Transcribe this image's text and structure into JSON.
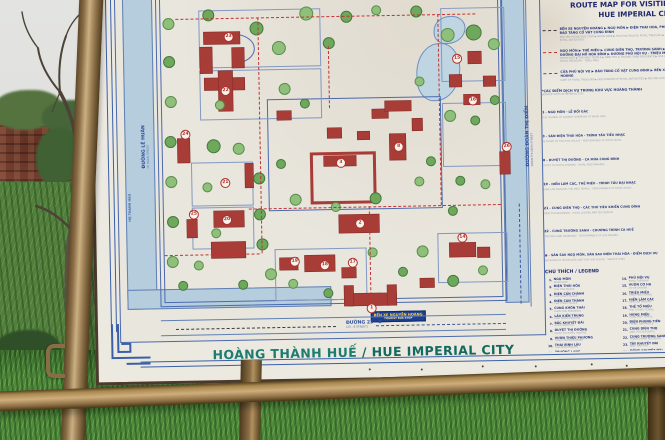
{
  "signboard": {
    "title": {
      "vi": "HOÀNG THÀNH HUẾ",
      "sep": " / ",
      "en": "HUE IMPERIAL CITY"
    },
    "bus_stop": {
      "line1": "BẾN XE NGUYỄN HOÀNG",
      "line2": "TOURIST BUS STOP"
    }
  },
  "legend": {
    "corner_code": "HMCC",
    "title_line1": "ROUTE MAP FOR VISITING",
    "title_line2": "HUE IMPERIAL CITY",
    "routes": [
      {
        "style": "black",
        "vi": "BẾN XE NGUYỄN HOÀNG ▶ NGỌ MÔN ▶ ĐIỆN THÁI HÒA, PHỦ NỘI VỤ ▶ BẢO TÀNG CỔ VẬT CUNG ĐÌNH",
        "en": "NGUYEN HOANG BUS STOP ▶ NOON GATE ▶ THAI HOA PALACE, ROYAL TREASURY ▶ HUE MUSEUM OF ROYAL ANTIQUITIES"
      },
      {
        "style": "red",
        "vi": "NGỌ MÔN ▶ THẾ MIẾU ▶ CUNG DIÊN THỌ, TRƯỜNG SANH ▶ TUYẾN ĐƯỜNG ĐẠI HỒ HÒA BÌNH ▶ ĐƯỜNG PHỦ NỘI VỤ - TRIỆU MIẾU",
        "en": "NOON GATE ▶ THE MIEU TEMPLE ▶ DIEN THO & TRUONG SANH RESIDENCE ▶ HOA BINH GATE ROUTE ▶ ROYAL TREASURY - TRIEU MIEU"
      },
      {
        "style": "blue",
        "vi": "CỬA PHỦ NỘI VỤ ▶ BẢO TÀNG CỔ VẬT CUNG ĐÌNH ▶ BẾN XE NGUYỄN HOÀNG",
        "en": "GATE OF ROYAL TREASURY ▶ HUE MUSEUM OF ROYAL ANTIQUITIES ▶ NGUYEN HOANG BUS STOP"
      }
    ],
    "services": {
      "heading_vi": "*CÁC ĐIỂM DỊCH VỤ TRONG KHU VỰC HOÀNG THÀNH",
      "heading_en": "SERVICE SITES IN IMPERIAL CITY",
      "items": [
        {
          "k": "1",
          "vi": "NGỌ MÔN - LỄ ĐỔI GÁC",
          "en": "THE CHANGE OF GUARDS CEREMONY AT NOON GATE"
        },
        {
          "k": "3",
          "vi": "SÂN ĐIỆN THÁI HÒA - TRÌNH TẤU TIỂU NHẠC",
          "en": "IN FRONT OF THAI HOA PALACE - PERFORMANCE OF ROYAL MUSIC"
        },
        {
          "k": "8",
          "vi": "DUYỆT THỊ ĐƯỜNG - CA MÚA CUNG ĐÌNH",
          "en": "DUYET THI ROYAL THEATRE - ROYAL PERFORMANCE"
        },
        {
          "k": "19",
          "vi": "HIỂN LÂM CÁC, THẾ MIẾU - TRÌNH TẤU ĐẠI NHẠC",
          "en": "HIEN LAM PAVILION, THE MIEU TEMPLE - PERFORMANCE OF ROYAL MUSIC"
        },
        {
          "k": "21",
          "vi": "CUNG DIÊN THỌ - CÁC THÚ TIÊU KHIỂN CUNG ĐÌNH",
          "en": "DIEN THO RESIDENCE - ROYAL LEISURE AND TEA SERVICE"
        },
        {
          "k": "22",
          "vi": "CUNG TRƯỜNG SANH - CHƯƠNG TRÌNH CA HUẾ",
          "en": "TRUONG SANH RESIDENCE - PERFORMANCE OF HUE SINGING"
        },
        {
          "k": "●",
          "vi": "SÂN SAU NGỌ MÔN, SÂN SAU ĐIỆN THÁI HÒA - ĐIỂM DỊCH VỤ",
          "en": "BACKYARD OF NOON GATE AND THAI HOA PALACE - SERVICE SITES"
        }
      ]
    },
    "legend_heading": "CHÚ THÍCH / LEGEND",
    "entries": [
      {
        "n": 1,
        "vi": "NGỌ MÔN",
        "en": "NOON GATE"
      },
      {
        "n": 2,
        "vi": "ĐIỆN THÁI HÒA",
        "en": "THAI HOA PALACE"
      },
      {
        "n": 3,
        "vi": "ĐIỆN CẦN CHÁNH",
        "en": "CAN CHANH PALACE"
      },
      {
        "n": 4,
        "vi": "ĐIỆN CÀN THÀNH",
        "en": "CAN THANH PALACE"
      },
      {
        "n": 5,
        "vi": "CUNG KHÔN THÁI",
        "en": "KHON THAI RESIDENCE"
      },
      {
        "n": 6,
        "vi": "LẦU KIẾN TRUNG",
        "en": "KIEN TRUNG PAVILION"
      },
      {
        "n": 7,
        "vi": "BẮC KHUYẾT ĐÀI",
        "en": "NORTH BASTION"
      },
      {
        "n": 8,
        "vi": "DUYỆT THỊ ĐƯỜNG",
        "en": "DUYET THI ROYAL THEATRE"
      },
      {
        "n": 9,
        "vi": "VƯỜN THIỆU PHƯƠNG",
        "en": "THIEU PHUONG GARDEN"
      },
      {
        "n": 10,
        "vi": "THÁI BÌNH LÂU",
        "en": "THAI BINH PAVILION"
      },
      {
        "n": 11,
        "vi": "TRƯỜNG LANG",
        "en": "LONG CORRIDOR"
      },
      {
        "n": 12,
        "vi": "HỮU TIỀN VIÊN PHÒNG",
        "en": "ROYAL OFFICE"
      },
      {
        "n": 13,
        "vi": "THÁI MIẾU",
        "en": "THAI MIEU TEMPLE"
      },
      {
        "n": 14,
        "vi": "PHỦ NỘI VỤ",
        "en": "ROYAL TREASURY"
      },
      {
        "n": 15,
        "vi": "VƯỜN CƠ HẠ",
        "en": "CO HA GARDEN"
      },
      {
        "n": 16,
        "vi": "TRIỆU MIẾU",
        "en": "TRIEU MIEU TEMPLE"
      },
      {
        "n": 17,
        "vi": "HIỂN LÂM CÁC",
        "en": "HIEN LAM PAVILION"
      },
      {
        "n": 18,
        "vi": "THẾ TỔ MIẾU",
        "en": "THE TO MIEU TEMPLE"
      },
      {
        "n": 19,
        "vi": "HƯNG MIẾU",
        "en": "HUNG MIEU TEMPLE"
      },
      {
        "n": 20,
        "vi": "ĐIỆN PHỤNG TIÊN",
        "en": "PHUNG TIEN PALACE"
      },
      {
        "n": 21,
        "vi": "CUNG DIÊN THỌ",
        "en": "DIEN THO RESIDENCE"
      },
      {
        "n": 22,
        "vi": "CUNG TRƯỜNG SANH",
        "en": "TRUONG SANH RESIDENCE"
      },
      {
        "n": 23,
        "vi": "TÂY KHUYẾT ĐÀI",
        "en": "WEST BASTION"
      },
      {
        "n": 24,
        "vi": "ĐÔNG KHUYẾT ĐÀI",
        "en": "EAST BASTION"
      },
      {
        "n": 25,
        "vi": "CỬA CHƯƠNG ĐỨC",
        "en": "CHUONG DUC GATE"
      },
      {
        "n": 26,
        "vi": "CỬA HIỂN NHƠN",
        "en": "HIEN NHON GATE"
      },
      {
        "n": 27,
        "vi": "CỬA HÒA BÌNH",
        "en": "HOA BINH GATE"
      }
    ]
  },
  "map": {
    "moats": [
      [
        7,
        30,
        28,
        324
      ],
      [
        7,
        336,
        202,
        18
      ],
      [
        385,
        30,
        22,
        324
      ]
    ],
    "lakes": [
      [
        300,
        95,
        42,
        56
      ],
      [
        318,
        68,
        30,
        26
      ]
    ],
    "walls": [
      [
        40,
        22,
        345,
        330
      ],
      [
        44,
        26,
        337,
        322
      ],
      [
        150,
        148,
        172,
        110
      ]
    ],
    "courtyards": [
      [
        73,
        210,
        60,
        42
      ],
      [
        73,
        255,
        60,
        40
      ],
      [
        155,
        298,
        90,
        50
      ],
      [
        318,
        285,
        68,
        48
      ],
      [
        325,
        60,
        62,
        72
      ],
      [
        83,
        58,
        120,
        56
      ],
      [
        83,
        118,
        120,
        48
      ],
      [
        325,
        155,
        62,
        62
      ]
    ],
    "arcs": [
      [
        118,
        82,
        20,
        28
      ]
    ],
    "streets_h": [
      [
        40,
        367,
        345,
        14
      ]
    ],
    "streets_v": [
      [
        410,
        28,
        15,
        332
      ]
    ],
    "buildings": [
      [
        228,
        344,
        48,
        12
      ],
      [
        224,
        336,
        9,
        20
      ],
      [
        267,
        336,
        9,
        20
      ],
      [
        220,
        265,
        40,
        18
      ],
      [
        206,
        206,
        32,
        10
      ],
      [
        160,
        160,
        14,
        9
      ],
      [
        255,
        160,
        16,
        9
      ],
      [
        295,
        170,
        10,
        12
      ],
      [
        210,
        178,
        14,
        10
      ],
      [
        240,
        182,
        12,
        8
      ],
      [
        272,
        185,
        16,
        26
      ],
      [
        268,
        152,
        26,
        10
      ],
      [
        333,
        127,
        12,
        12
      ],
      [
        367,
        129,
        12,
        10
      ],
      [
        347,
        147,
        16,
        10
      ],
      [
        352,
        104,
        13,
        12
      ],
      [
        88,
        80,
        36,
        12
      ],
      [
        84,
        95,
        12,
        26
      ],
      [
        116,
        96,
        12,
        20
      ],
      [
        88,
        126,
        40,
        12
      ],
      [
        102,
        119,
        14,
        40
      ],
      [
        60,
        186,
        12,
        24
      ],
      [
        127,
        212,
        8,
        24
      ],
      [
        95,
        259,
        30,
        16
      ],
      [
        92,
        290,
        34,
        16
      ],
      [
        68,
        267,
        10,
        18
      ],
      [
        185,
        305,
        30,
        16
      ],
      [
        160,
        307,
        18,
        12
      ],
      [
        222,
        318,
        14,
        10
      ],
      [
        330,
        295,
        26,
        14
      ],
      [
        358,
        300,
        12,
        10
      ],
      [
        382,
        205,
        10,
        22
      ],
      [
        300,
        330,
        14,
        9
      ]
    ],
    "red_outlines": [
      [
        192,
        202,
        60,
        46
      ]
    ],
    "markers": [
      [
        1,
        250,
        358
      ],
      [
        2,
        240,
        273
      ],
      [
        3,
        222,
        212
      ],
      [
        8,
        280,
        197
      ],
      [
        14,
        342,
        289
      ],
      [
        15,
        340,
        110
      ],
      [
        16,
        355,
        152
      ],
      [
        17,
        232,
        312
      ],
      [
        18,
        204,
        314
      ],
      [
        19,
        174,
        310
      ],
      [
        20,
        107,
        267
      ],
      [
        21,
        106,
        230
      ],
      [
        22,
        108,
        138
      ],
      [
        23,
        112,
        84
      ],
      [
        24,
        67,
        181
      ],
      [
        25,
        74,
        261
      ],
      [
        26,
        388,
        199
      ]
    ],
    "trees": [
      [
        52,
        70,
        5
      ],
      [
        52,
        108,
        5
      ],
      [
        53,
        148,
        5
      ],
      [
        52,
        188,
        5
      ],
      [
        52,
        228,
        5
      ],
      [
        53,
        268,
        5
      ],
      [
        52,
        308,
        5
      ],
      [
        95,
        193,
        6
      ],
      [
        120,
        196,
        5
      ],
      [
        140,
        226,
        5
      ],
      [
        88,
        234,
        4
      ],
      [
        140,
        262,
        5
      ],
      [
        96,
        280,
        4
      ],
      [
        142,
        292,
        5
      ],
      [
        150,
        322,
        5
      ],
      [
        122,
        332,
        4
      ],
      [
        172,
        332,
        4
      ],
      [
        140,
        76,
        6
      ],
      [
        162,
        96,
        6
      ],
      [
        92,
        62,
        5
      ],
      [
        190,
        62,
        6
      ],
      [
        212,
        92,
        5
      ],
      [
        167,
        137,
        5
      ],
      [
        187,
        152,
        4
      ],
      [
        176,
        248,
        5
      ],
      [
        256,
        248,
        5
      ],
      [
        216,
        256,
        4
      ],
      [
        162,
        212,
        4
      ],
      [
        300,
        232,
        4
      ],
      [
        312,
        212,
        4
      ],
      [
        332,
        167,
        5
      ],
      [
        357,
        172,
        4
      ],
      [
        331,
        86,
        6
      ],
      [
        357,
        84,
        7
      ],
      [
        377,
        96,
        5
      ],
      [
        341,
        232,
        4
      ],
      [
        366,
        236,
        4
      ],
      [
        333,
        262,
        4
      ],
      [
        302,
        302,
        5
      ],
      [
        332,
        332,
        5
      ],
      [
        362,
        322,
        4
      ],
      [
        282,
        322,
        4
      ],
      [
        252,
        302,
        4
      ],
      [
        207,
        342,
        4
      ],
      [
        302,
        132,
        4
      ],
      [
        377,
        152,
        4
      ],
      [
        102,
        152,
        4
      ],
      [
        62,
        332,
        4
      ],
      [
        78,
        312,
        4
      ],
      [
        230,
        66,
        5
      ],
      [
        260,
        60,
        4
      ],
      [
        300,
        62,
        5
      ]
    ],
    "routes_red": [
      [
        "h",
        60,
        66,
        300
      ],
      [
        "v",
        142,
        66,
        236
      ],
      [
        "h",
        45,
        302,
        95
      ],
      [
        "h",
        130,
        257,
        252
      ],
      [
        "v",
        250,
        257,
        104
      ],
      [
        "v",
        322,
        66,
        191
      ],
      [
        "v",
        212,
        96,
        62
      ]
    ],
    "routes_blue": [
      [
        "v",
        400,
        257,
        100
      ],
      [
        "h",
        255,
        376,
        130
      ]
    ],
    "routes_black": [
      [
        "h",
        55,
        376,
        160
      ]
    ],
    "labels": [
      {
        "t": "ĐƯỜNG LÊ HUÂN",
        "s": "LE HUAN STREET",
        "x": 24,
        "y": 215,
        "r": -90,
        "small": false
      },
      {
        "t": "HỘ THÀNH HÀO",
        "s": "",
        "x": 10,
        "y": 268,
        "r": -90,
        "small": true
      },
      {
        "t": "ĐƯỜNG ĐOÀN THỊ ĐIỂM",
        "s": "DOAN THI DIEM STREET",
        "x": 408,
        "y": 220,
        "r": -90,
        "small": false
      },
      {
        "t": "ĐƯỜNG  23 - 8",
        "s": "(23 - 8 STREET)",
        "x": 225,
        "y": 371,
        "r": 0,
        "small": false
      }
    ]
  },
  "colors": {
    "sign_face": "#ece9e1",
    "map_paper": "#e9e6dd",
    "line_blue": "#4a69ad",
    "building_red": "#a83c36",
    "route_red": "#c23232",
    "moat_blue": "#b5cddc",
    "title_teal": "#1b7c6f",
    "legend_navy": "#2a3c80",
    "brass_frame": "#a98d5f",
    "grass_green": "#4e8a39",
    "brick_wall": "#7d4434"
  }
}
